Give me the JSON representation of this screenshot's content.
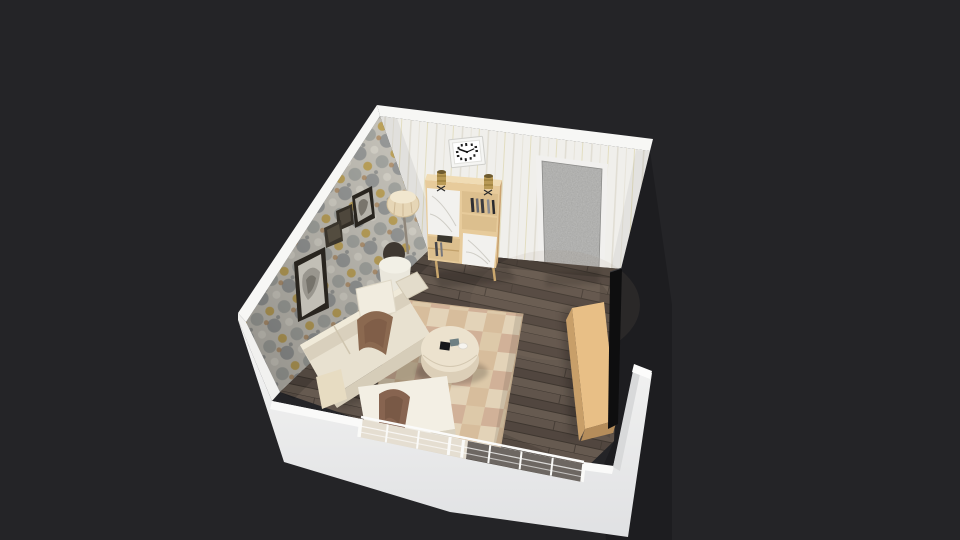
{
  "app": {
    "name": "3d-home-planner",
    "view": "perspective-3d-room-view"
  },
  "canvas": {
    "width": 960,
    "height": 540,
    "background": "#242427"
  },
  "scene": {
    "room": {
      "walls": {
        "ridge": "#f7f7f5",
        "back_wall_base": "#f0efeb",
        "wallpaper_base": "#cbc8bf",
        "front_wall_shadow_face": "#d8d9da",
        "cut_wall_dark": "#1d1d20"
      },
      "floor": {
        "base": "#5a4f47"
      },
      "door": {
        "face": "#a3a3a1",
        "frame": "#f1f0ee"
      },
      "window": {
        "glass_left": "#ded5c5",
        "glass_right": "#453d36",
        "frame": "#fafaf8"
      }
    },
    "furniture": {
      "sofa": {
        "body": "#e8e1d0",
        "backrest": "#d9d0bd",
        "skirt": "#d6cdb9",
        "pillow_white": "#f1ecdf",
        "pillow_brown": "#8b6950",
        "pillow_beige": "#e7dcc2"
      },
      "chaise": {
        "body": "#f3efe4",
        "pillow_brown": "#876450"
      },
      "coffee_table": {
        "top": "#ece2ce",
        "side": "#dccfb8"
      },
      "rug": {
        "base": "#dfcbad"
      },
      "tv_stand": {
        "top": "#e8bf86",
        "side": "#c89f69",
        "base": "#b58d5b"
      },
      "tv": {
        "screen": "#0e0e0f"
      },
      "bookcase": {
        "wood": "#e7cb9b",
        "top": "#f0dcb4",
        "doors": "#f2f1ee",
        "shelf": "#dcbf8e"
      },
      "floor_lamp": {
        "shade": "#e6d6b6"
      },
      "side_table": {
        "pot": "#eae7dc",
        "vase": "#3f3831"
      },
      "clock": {
        "frame": "#f5f5f3"
      },
      "wall_frames": {
        "frame": "#29251f"
      }
    },
    "objects": [
      "wallpaper-accent-wall",
      "striped-back-wall",
      "wood-plank-floor",
      "sectional-sofa",
      "chaise-ottoman",
      "round-coffee-table",
      "checkered-area-rug",
      "tv-sideboard",
      "flat-tv",
      "bookcase-cabinet",
      "candle-holders",
      "wall-clock",
      "textured-interior-door",
      "floor-lamp",
      "side-table-with-vase",
      "wall-art-frames",
      "wall-box-shelves",
      "window-wall",
      "balcony-railing"
    ]
  }
}
